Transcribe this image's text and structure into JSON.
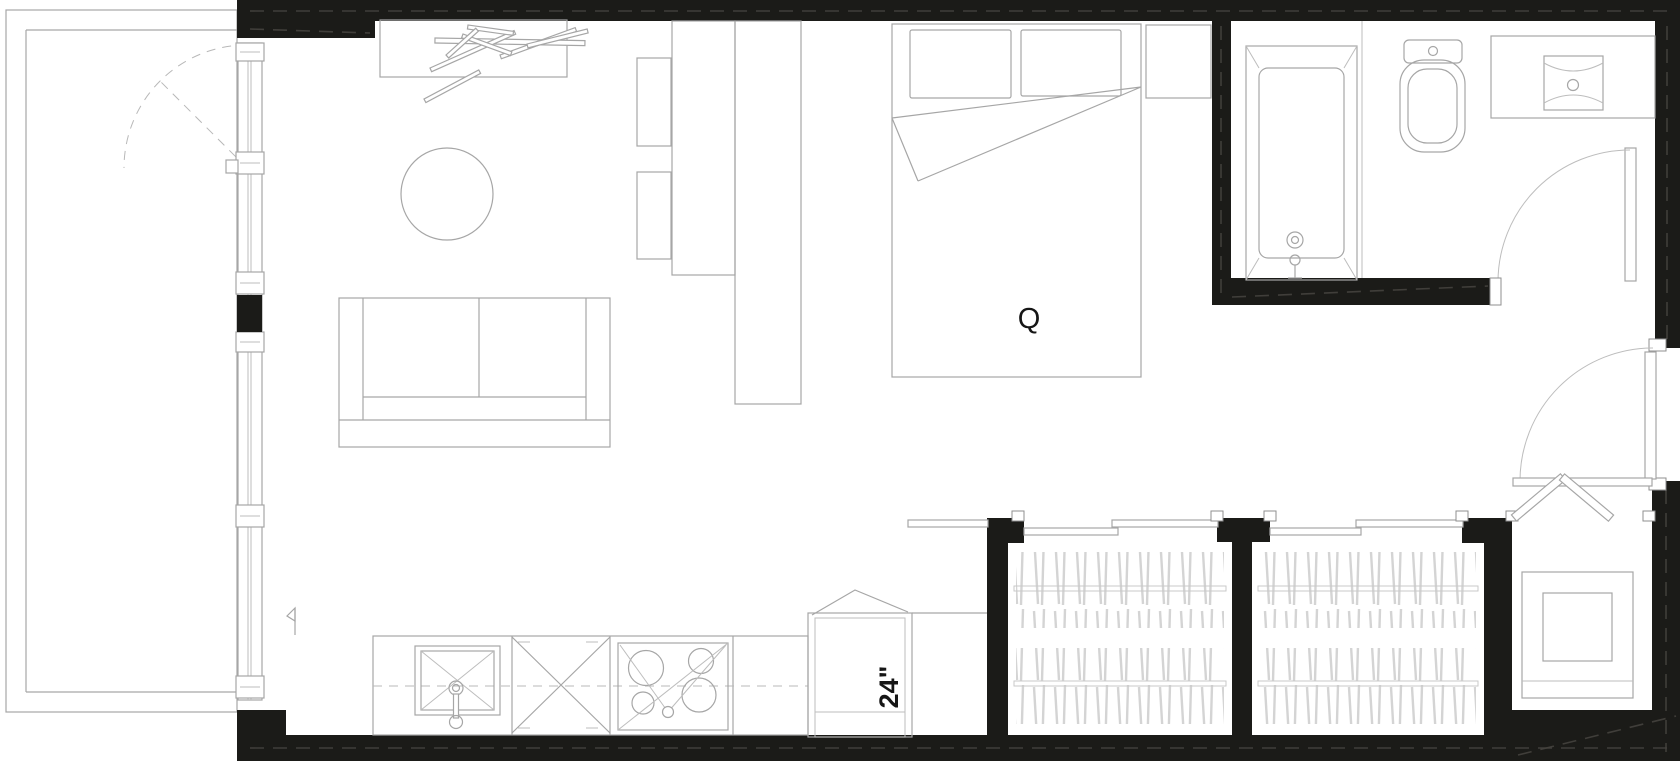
{
  "document": {
    "type": "architectural-floor-plan",
    "title": "Studio apartment floor plan",
    "style": "black poche walls, thin gray fixture linework on white"
  },
  "labels": {
    "bed_size": "Q",
    "fridge_width": "24\""
  },
  "colors": {
    "background": "#ffffff",
    "wall": "#1b1b18",
    "wall_seam": "#45433e",
    "fixture_line": "#a6a6a6",
    "light_line": "#bdbdbd",
    "hatch": "#d4d4d4",
    "text": "#161616"
  },
  "rooms": [
    {
      "name": "balcony",
      "position": "left",
      "features": [
        "parapet outline",
        "dashed door swing"
      ]
    },
    {
      "name": "living-sleeping-area",
      "position": "center",
      "furniture": [
        "desk with scattered sticks",
        "round table",
        "sofa",
        "two seats",
        "tall counters",
        "queen bed",
        "nightstand"
      ]
    },
    {
      "name": "kitchen",
      "position": "bottom-left",
      "fixtures": [
        "sink",
        "dishwasher",
        "4-burner cooktop",
        "refrigerator 24\""
      ]
    },
    {
      "name": "bathroom",
      "position": "top-right",
      "fixtures": [
        "bathtub",
        "toilet",
        "vanity sink",
        "swing door"
      ]
    },
    {
      "name": "entry",
      "position": "right",
      "features": [
        "entry door swing arc"
      ]
    },
    {
      "name": "closet-1",
      "position": "bottom-center",
      "features": [
        "sliding doors",
        "hanging rods with clothes hatch"
      ]
    },
    {
      "name": "closet-2",
      "position": "bottom-center-right",
      "features": [
        "sliding doors",
        "hanging rods with clothes hatch"
      ]
    },
    {
      "name": "laundry-closet",
      "position": "bottom-right",
      "features": [
        "bifold door",
        "washer-dryer"
      ]
    }
  ],
  "doors": [
    {
      "name": "balcony-door",
      "style": "dashed swing arc"
    },
    {
      "name": "bathroom-door",
      "style": "quarter arc with leaf"
    },
    {
      "name": "entry-door",
      "style": "quarter arc with leaf"
    },
    {
      "name": "laundry-bifold-door",
      "style": "V-fold panels"
    },
    {
      "name": "closet-sliding-doors",
      "style": "offset bypass tracks"
    }
  ],
  "window_wall": {
    "name": "balcony-window-wall",
    "style": "full-height glazing with mullion blocks"
  }
}
